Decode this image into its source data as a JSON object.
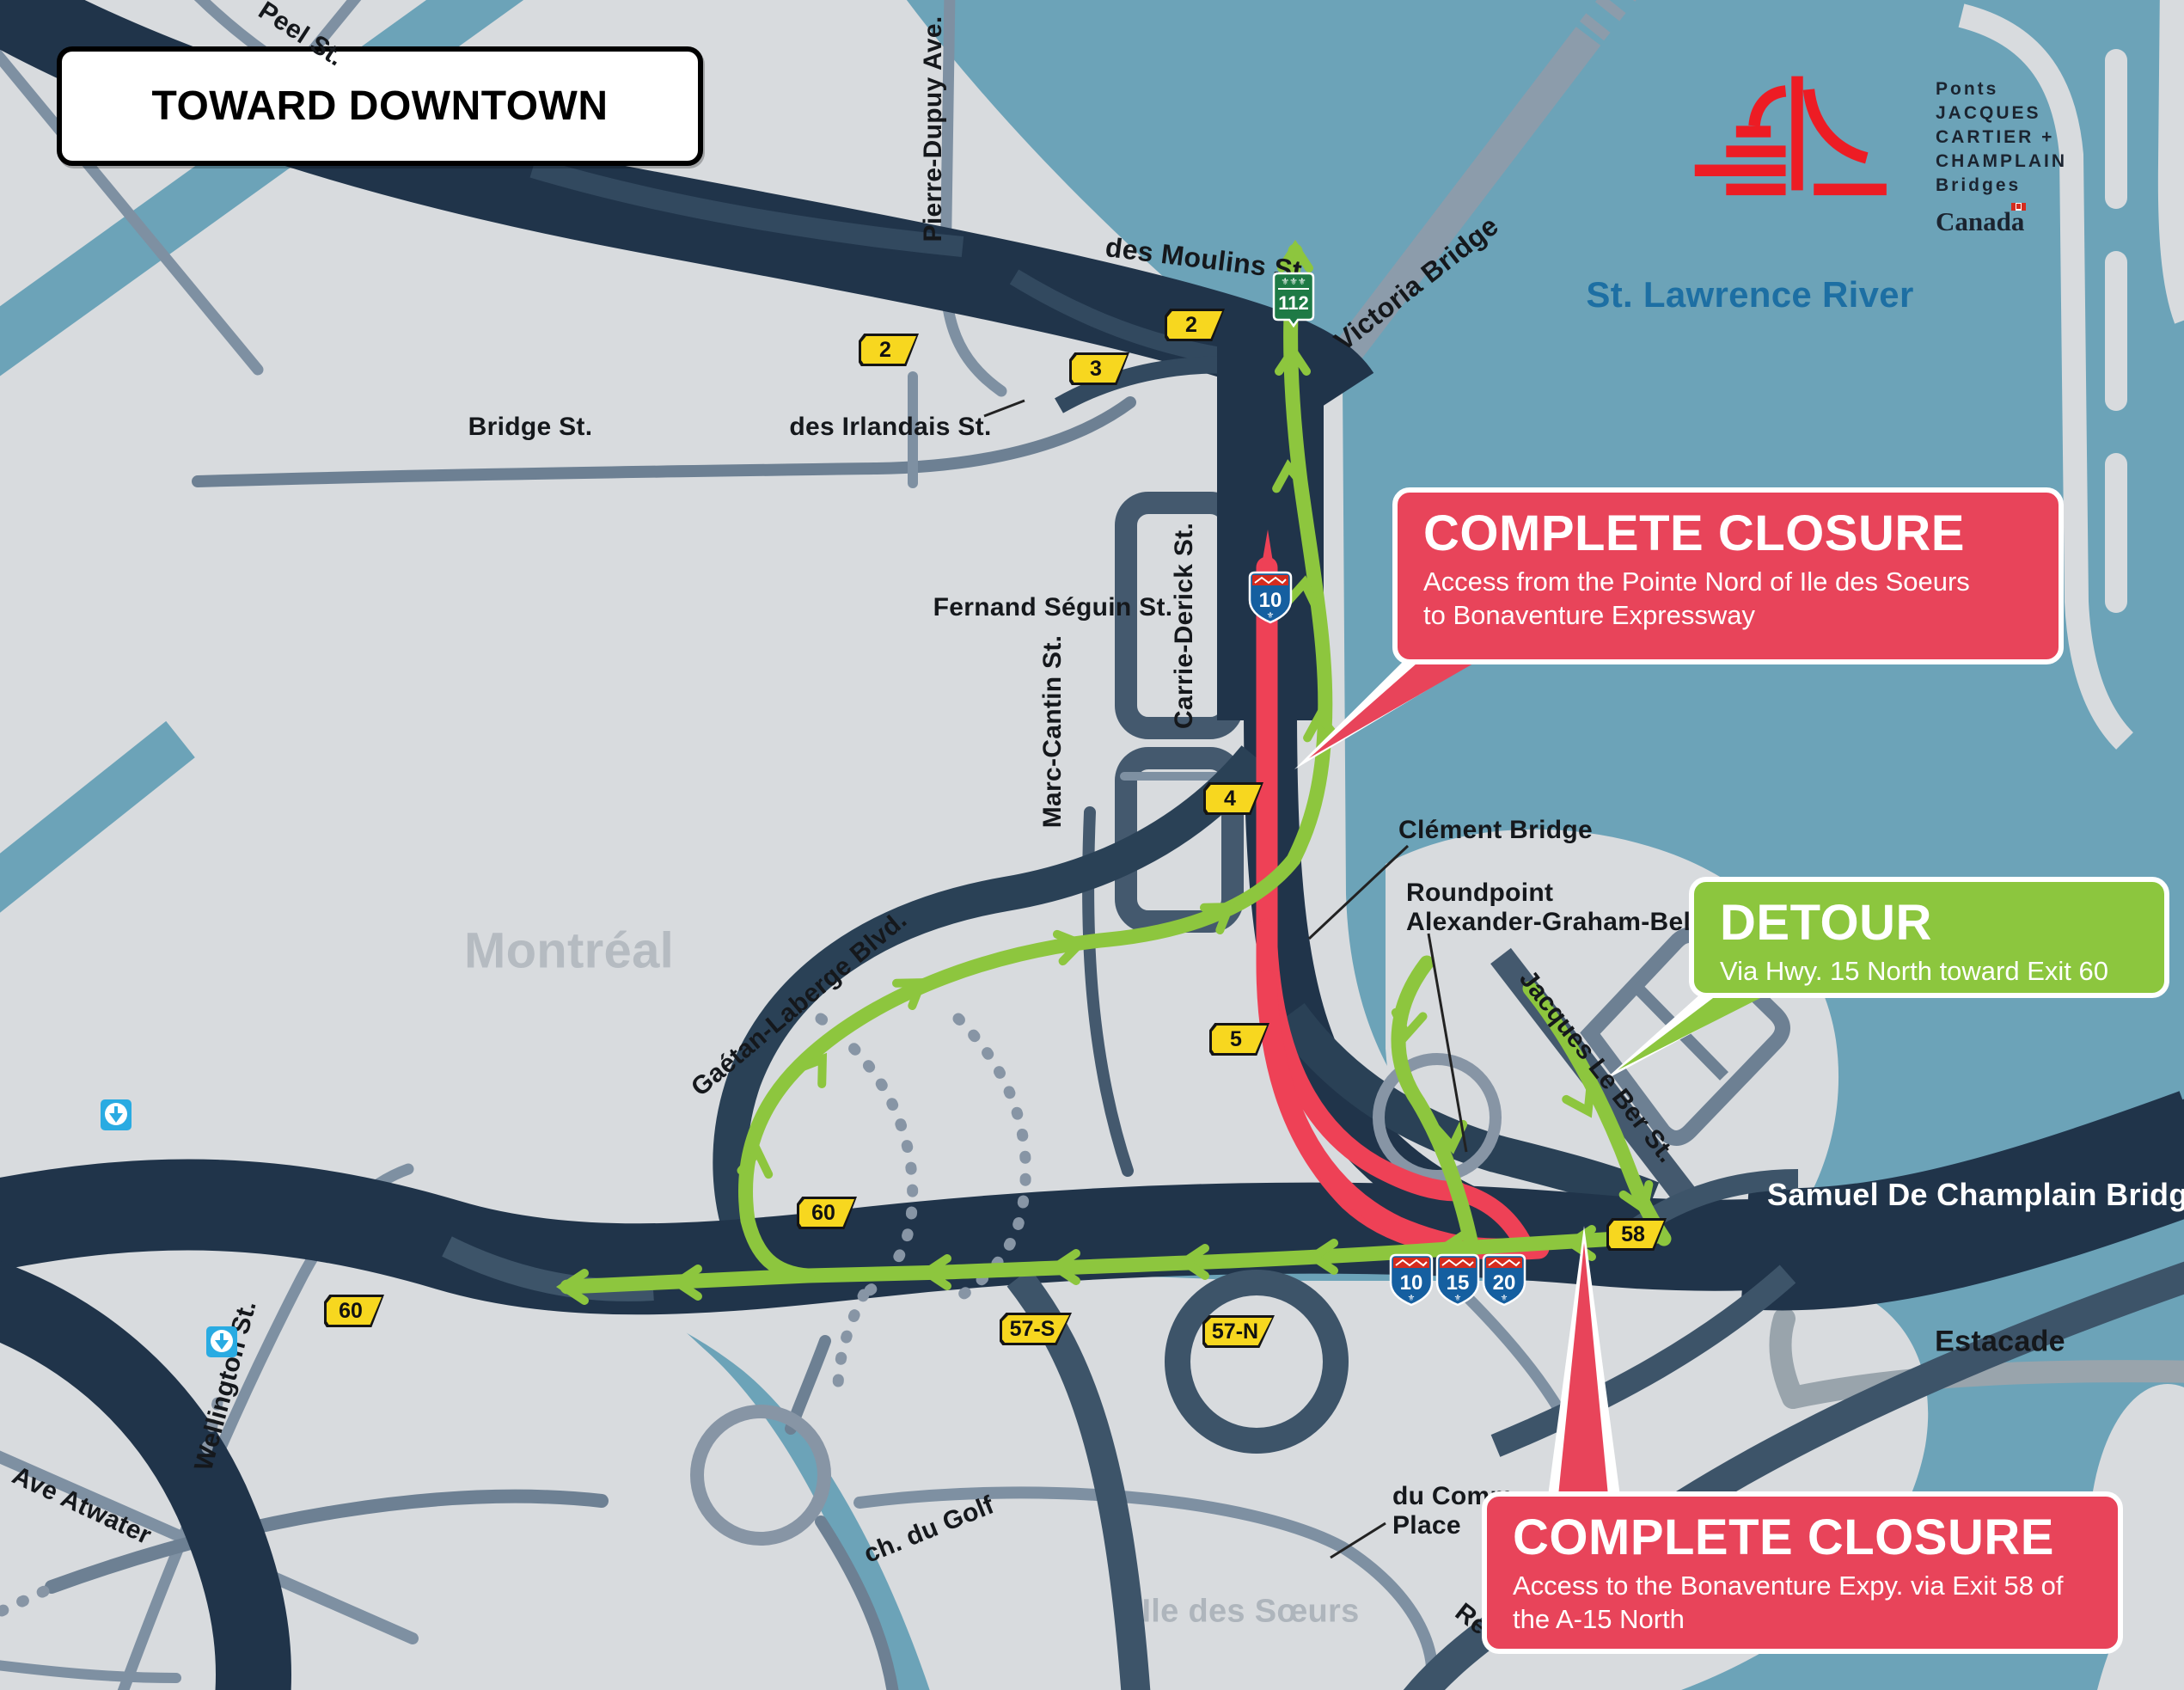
{
  "banner": {
    "label": "TOWARD DOWNTOWN"
  },
  "logo": {
    "line1": "Ponts",
    "line2": "JACQUES CARTIER +",
    "line3": "CHAMPLAIN",
    "line4": "Bridges",
    "wordmark": "Canada"
  },
  "map": {
    "water_label": "St. Lawrence River",
    "city_label": "Montréal",
    "island_label": "Ile des Sœurs",
    "streets": {
      "peel": "Peel St.",
      "pierre_dupuy": "Pierre-Dupuy Ave.",
      "des_moulins": "des Moulins St.",
      "victoria": "Victoria Bridge",
      "bridge": "Bridge St.",
      "des_irlandais": "des Irlandais St.",
      "fernand_seguin": "Fernand Séguin St.",
      "carrie_derick": "Carrie-Derick St.",
      "marc_cantin": "Marc-Cantin St.",
      "gaetan_laberge": "Gaétan-Laberge Blvd.",
      "clement": "Clément Bridge",
      "roundpoint_l1": "Roundpoint",
      "roundpoint_l2": "Alexander-Graham-Bell",
      "jacques_le_ber": "Jacques Le Ber St.",
      "wellington": "Wellington St.",
      "ave_atwater": "Ave Atwater",
      "ch_du_golf": "ch. du Golf",
      "du_comm_l1": "du Comm",
      "du_comm_l2": "Place",
      "re_partial": "Re",
      "samuel_de_champlain": "Samuel De Champlain Bridge",
      "estacade": "Estacade"
    },
    "exits": {
      "e2a": "2",
      "e2b": "2",
      "e3": "3",
      "e4": "4",
      "e5": "5",
      "e60a": "60",
      "e60b": "60",
      "e58": "58",
      "e57s": "57-S",
      "e57n": "57-N"
    },
    "shields": {
      "a10_top": "10",
      "a10": "10",
      "a15": "15",
      "a20": "20",
      "r112": "112"
    }
  },
  "callouts": {
    "closure_top": {
      "title": "COMPLETE CLOSURE",
      "line1": "Access from the Pointe Nord of Ile des Soeurs",
      "line2": "to Bonaventure Expressway"
    },
    "detour": {
      "title": "DETOUR",
      "line1": "Via Hwy. 15 North toward Exit 60"
    },
    "closure_bottom": {
      "title": "COMPLETE CLOSURE",
      "line1": "Access to the Bonaventure Expy. via Exit 58 of",
      "line2": "the A-15 North"
    }
  },
  "colors": {
    "water": "#6CA3B8",
    "land": "#D8DBDE",
    "road_dark": "#20344A",
    "road_mid": "#3D5469",
    "road_light": "#7E90A2",
    "closure_red": "#E8445A",
    "detour_green": "#8CC63E",
    "exit_yellow": "#F7D71F",
    "shield_blue": "#155FA0",
    "shield_red": "#D52B1E",
    "route112_green": "#1E7A45",
    "metro_blue": "#29ABE2",
    "river_text": "#1D6FA3"
  }
}
